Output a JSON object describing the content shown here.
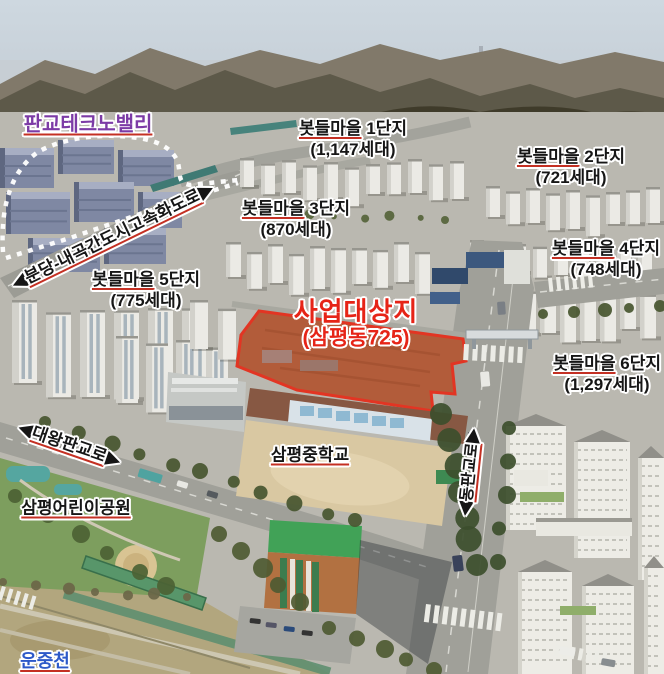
{
  "labels": {
    "techno_valley": {
      "text": "판교테크노밸리",
      "color": "#7c3ba6"
    },
    "site": {
      "title": "사업대상지",
      "subtitle": "(삼평동725)",
      "color": "#e62417"
    },
    "complexes": [
      {
        "village": "봇들마을",
        "unit": "1단지",
        "households": "(1,147세대)"
      },
      {
        "village": "봇들마을",
        "unit": "2단지",
        "households": "(721세대)"
      },
      {
        "village": "봇들마을",
        "unit": "3단지",
        "households": "(870세대)"
      },
      {
        "village": "봇들마을",
        "unit": "4단지",
        "households": "(748세대)"
      },
      {
        "village": "봇들마을",
        "unit": "5단지",
        "households": "(775세대)"
      },
      {
        "village": "봇들마을",
        "unit": "6단지",
        "households": "(1,297세대)"
      }
    ],
    "roads": [
      {
        "text": "분당-내곡간도시고속화도로"
      },
      {
        "text": "대왕판교로"
      },
      {
        "text": "동판교로"
      }
    ],
    "places": [
      {
        "text": "삼평중학교"
      },
      {
        "text": "삼평어린이공원"
      },
      {
        "text": "운중천",
        "color": "#2d59c8"
      }
    ],
    "arrows": {
      "left": "◀",
      "right": "▶"
    }
  }
}
